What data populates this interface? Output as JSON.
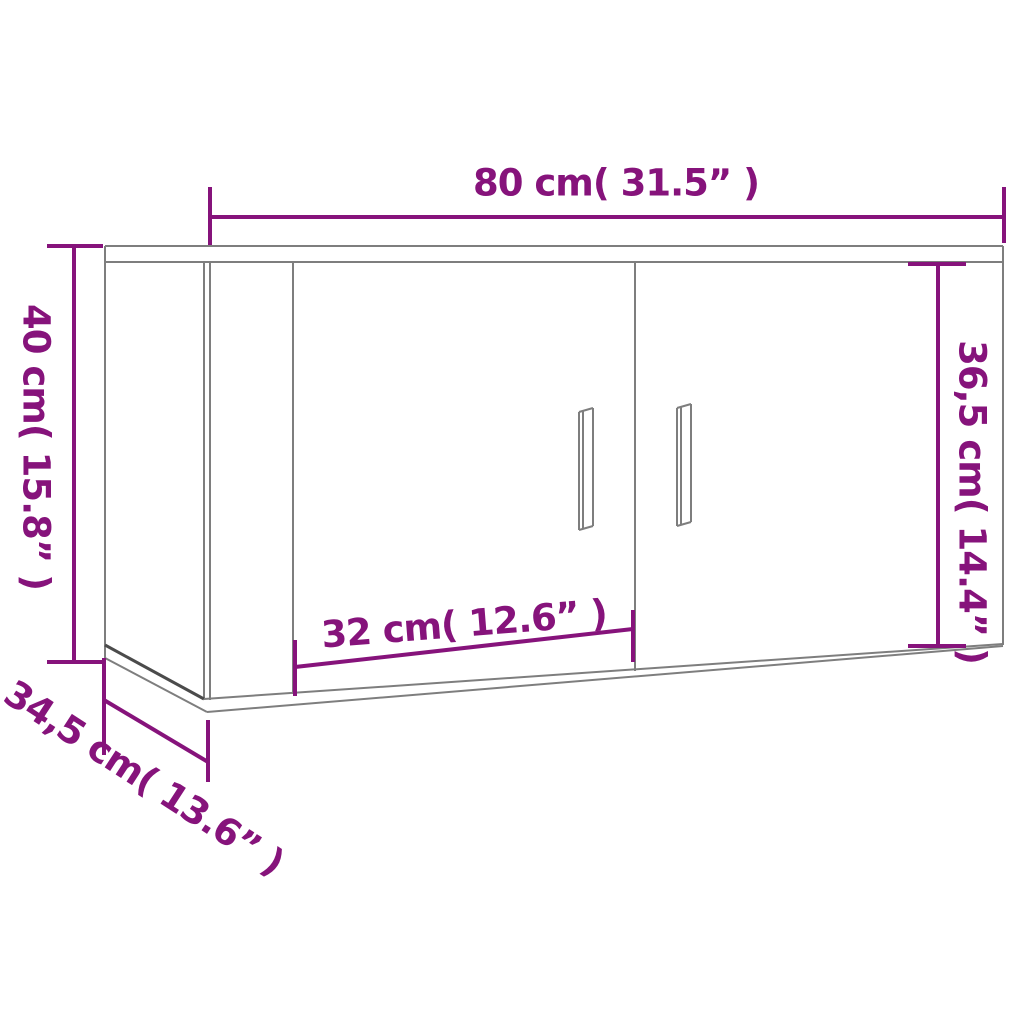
{
  "diagram": {
    "type": "furniture-dimension-diagram",
    "subject": "wall-mounted cabinet with two doors",
    "accent_color": "#86137b",
    "outline_color": "#7e7e7e",
    "background_color": "#ffffff",
    "dimensions": {
      "width": "80 cm( 31.5” )",
      "height": "40 cm( 15.8” )",
      "door_height": "36,5 cm( 14.4” )",
      "door_width": "32 cm( 12.6” )",
      "depth": "34,5 cm( 13.6” )"
    }
  }
}
